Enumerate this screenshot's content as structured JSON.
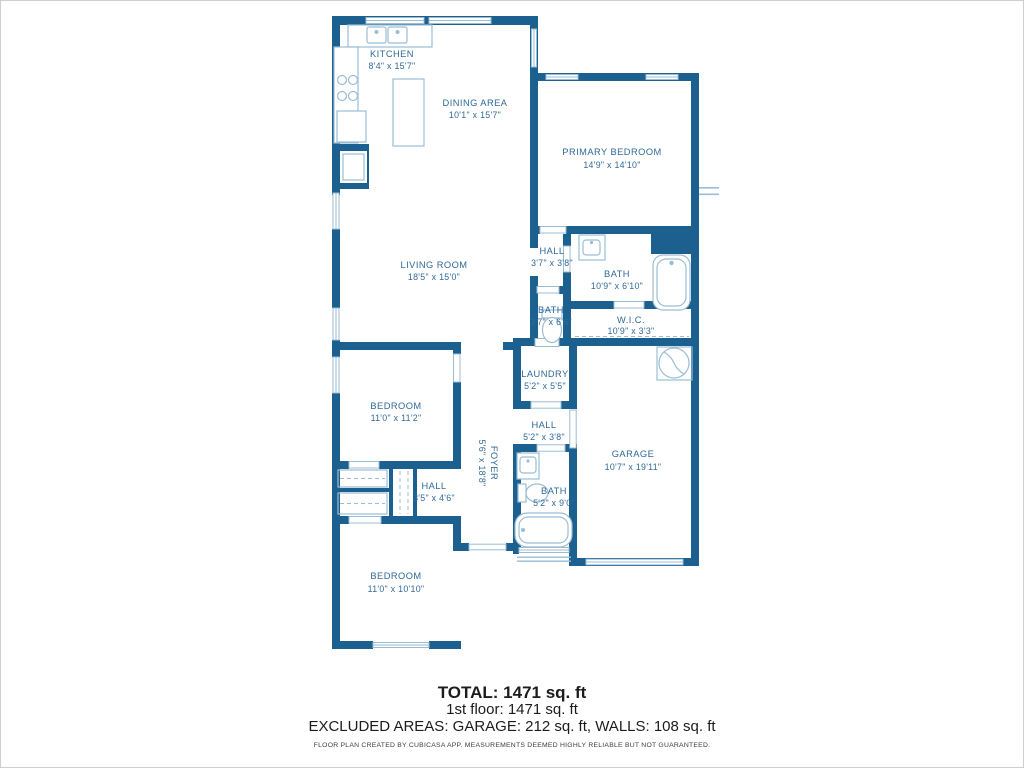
{
  "colors": {
    "wall": "#1c608f",
    "label": "#30699a",
    "fixture": "#9bbdd4"
  },
  "rooms": {
    "kitchen": {
      "name": "KITCHEN",
      "dims": "8'4\" x 15'7\""
    },
    "dining": {
      "name": "DINING AREA",
      "dims": "10'1\" x 15'7\""
    },
    "primary_bedroom": {
      "name": "PRIMARY BEDROOM",
      "dims": "14'9\" x 14'10\""
    },
    "living_room": {
      "name": "LIVING ROOM",
      "dims": "18'5\" x 15'0\""
    },
    "hall_upper": {
      "name": "HALL",
      "dims": "3'7\" x 3'8\""
    },
    "bath_primary": {
      "name": "BATH",
      "dims": "10'9\" x 6'10\""
    },
    "bath_small": {
      "name": "BATH",
      "dims": "3'7\" x 6'6\""
    },
    "wic": {
      "name": "W.I.C.",
      "dims": "10'9\" x 3'3\""
    },
    "bedroom_mid": {
      "name": "BEDROOM",
      "dims": "11'0\" x 11'2\""
    },
    "foyer": {
      "name": "FOYER",
      "dims": "5'6\" x 18'8\""
    },
    "laundry": {
      "name": "LAUNDRY",
      "dims": "5'2\" x 5'5\""
    },
    "hall_mid": {
      "name": "HALL",
      "dims": "5'2\" x 3'8\""
    },
    "bath_lower": {
      "name": "BATH",
      "dims": "5'2\" x 9'0\""
    },
    "garage": {
      "name": "GARAGE",
      "dims": "10'7\" x 19'11\""
    },
    "hall_lower": {
      "name": "HALL",
      "dims": "3'5\" x 4'6\""
    },
    "bedroom_lower": {
      "name": "BEDROOM",
      "dims": "11'0\" x 10'10\""
    }
  },
  "summary": {
    "total": "TOTAL: 1471 sq. ft",
    "first_floor": "1st floor: 1471 sq. ft",
    "excluded": "EXCLUDED AREAS: GARAGE: 212 sq. ft, WALLS: 108 sq. ft",
    "disclaimer": "FLOOR PLAN CREATED BY CUBICASA APP. MEASUREMENTS DEEMED HIGHLY RELIABLE BUT NOT GUARANTEED."
  }
}
